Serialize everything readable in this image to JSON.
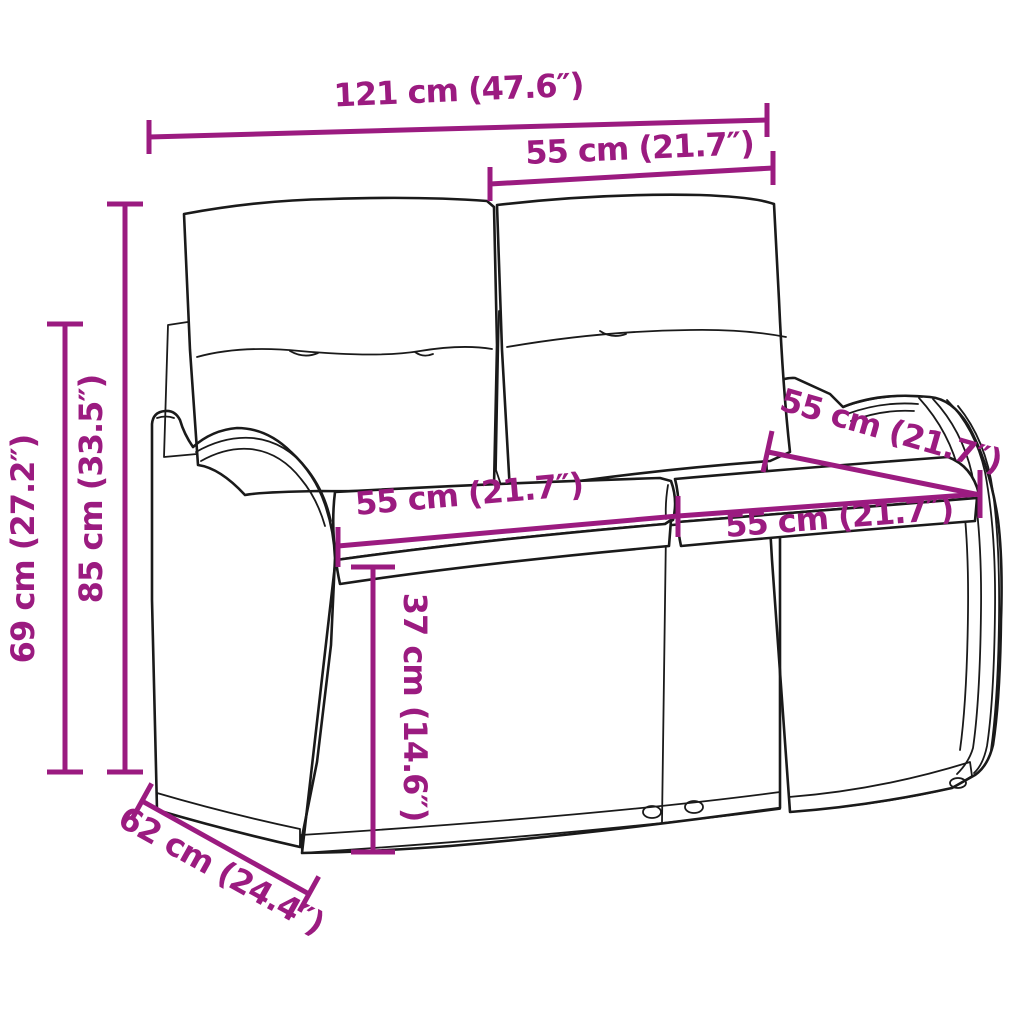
{
  "title": "Rattan garden bench dimension diagram",
  "colors": {
    "dimension": "#9B1B80",
    "line_art": "#1a1a1a",
    "background": "#ffffff"
  },
  "dimensions": [
    {
      "id": "overall-width",
      "label": "121 cm (47.6″)"
    },
    {
      "id": "backrest-section-width",
      "label": "55 cm (21.7″)"
    },
    {
      "id": "overall-height",
      "label": "85 cm (33.5″)"
    },
    {
      "id": "armrest-height",
      "label": "69 cm (27.2″)"
    },
    {
      "id": "seat-width-left",
      "label": "55 cm (21.7″)"
    },
    {
      "id": "seat-width-right",
      "label": "55 cm (21.7″)"
    },
    {
      "id": "seat-depth",
      "label": "55 cm (21.7″)"
    },
    {
      "id": "seat-height",
      "label": "37 cm (14.6″)"
    },
    {
      "id": "overall-depth",
      "label": "62 cm (24.4″)"
    }
  ]
}
